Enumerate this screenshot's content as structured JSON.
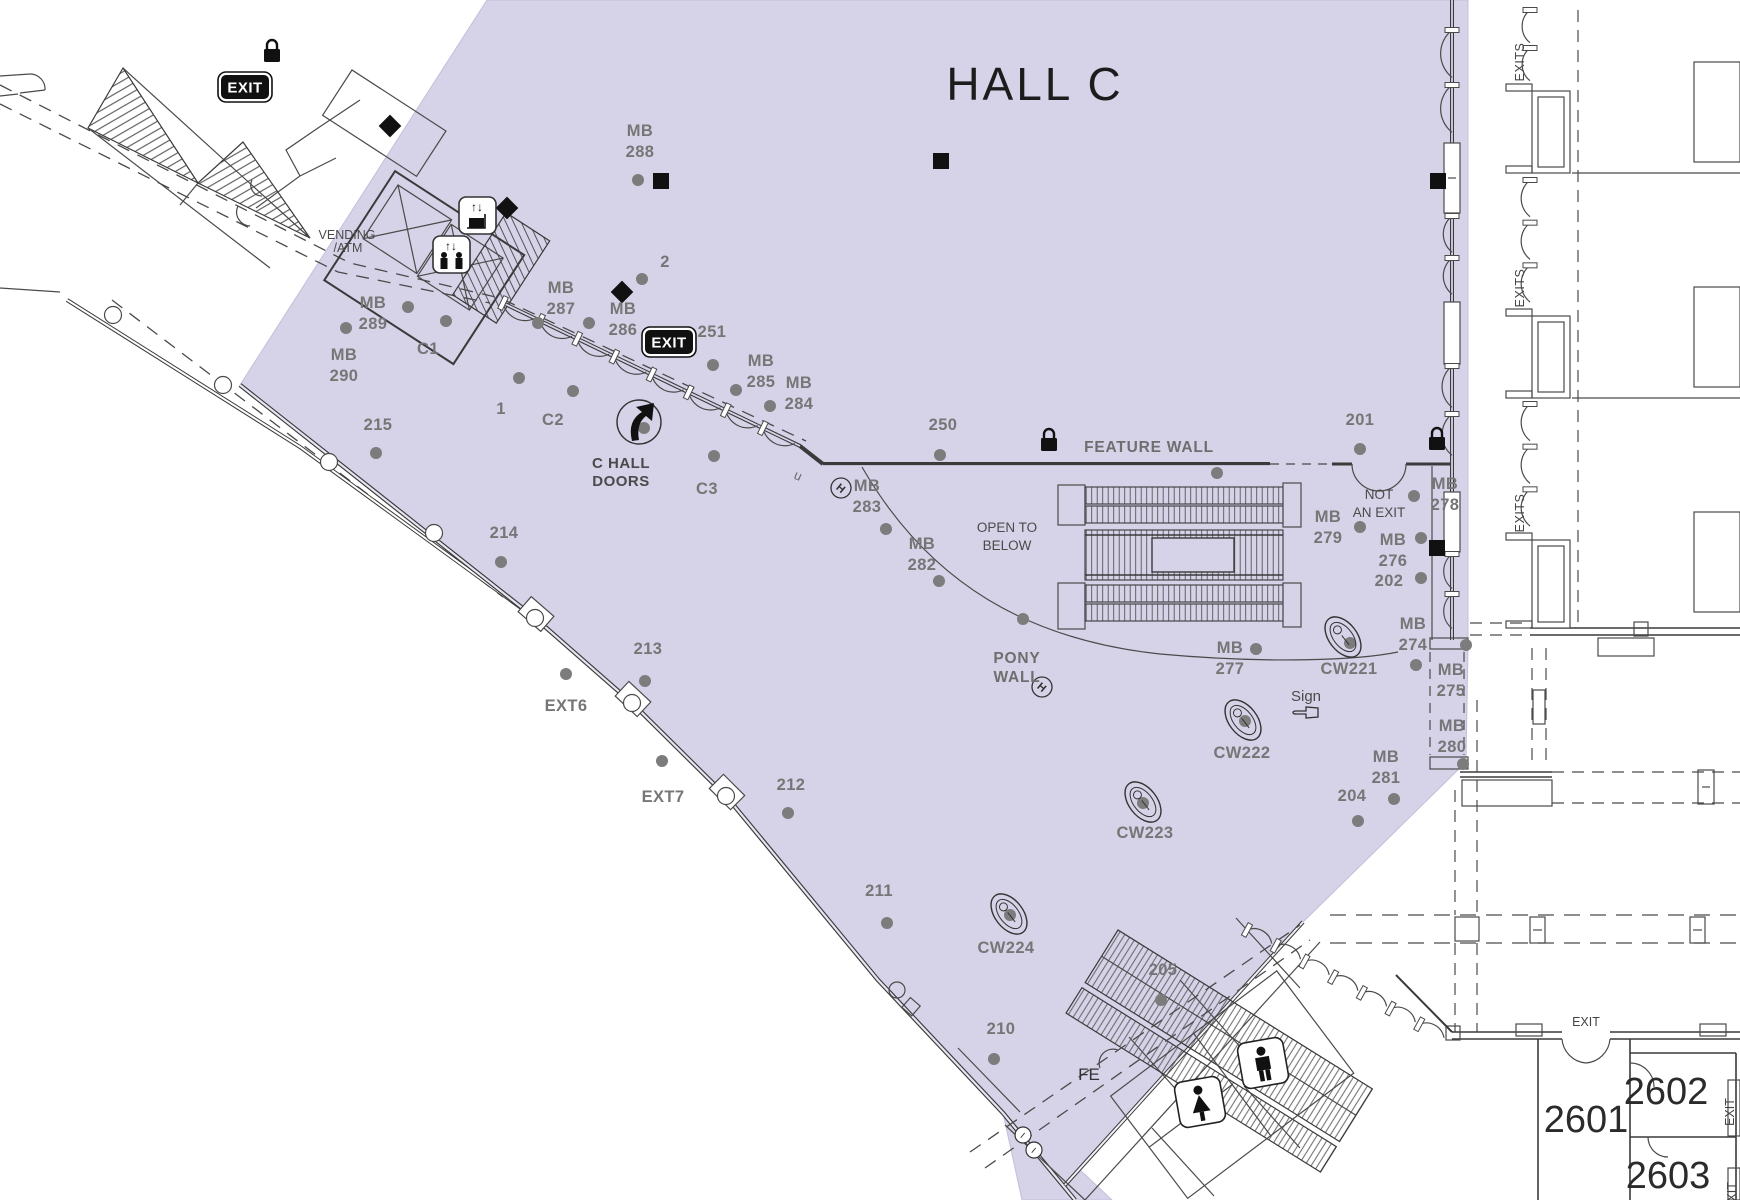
{
  "title": "HALL C",
  "colors": {
    "hall_fill": "#d6d3e8",
    "wall": "#3a3a3a",
    "marker_text": "#767676",
    "dot": "#7c7c7c",
    "dark_text": "#4a4a4a",
    "badge_black": "#111111"
  },
  "labels": {
    "exit": "EXIT",
    "exits": "EXITS",
    "feature_wall": "FEATURE WALL",
    "pony_wall": [
      "PONY",
      "WALL"
    ],
    "open_to_below": [
      "OPEN TO",
      "BELOW"
    ],
    "not_an_exit": [
      "NOT",
      "AN EXIT"
    ],
    "c_hall_doors": [
      "C HALL",
      "DOORS"
    ],
    "vending_atm": [
      "VENDING",
      "/ATM"
    ],
    "sign": "Sign",
    "fe": "FE",
    "u_mark": "u"
  },
  "rooms": [
    {
      "number": "2601",
      "x": 1586,
      "y": 1132
    },
    {
      "number": "2602",
      "x": 1666,
      "y": 1104
    },
    {
      "number": "2603",
      "x": 1668,
      "y": 1188
    }
  ],
  "exit_badges": [
    {
      "x": 245,
      "y": 87
    },
    {
      "x": 669,
      "y": 342
    }
  ],
  "exit_small_labels": [
    {
      "x": 1586,
      "y": 1026,
      "rotate": 0
    },
    {
      "x": 1734,
      "y": 1112,
      "rotate": -90
    },
    {
      "x": 1736,
      "y": 1196,
      "rotate": -90
    }
  ],
  "exits_corridor_labels": [
    {
      "x": 1524,
      "y": 62
    },
    {
      "x": 1524,
      "y": 288
    },
    {
      "x": 1524,
      "y": 513
    }
  ],
  "markers": [
    {
      "lines": [
        "MB",
        "288"
      ],
      "x": 640,
      "y": 136
    },
    {
      "lines": [
        "MB",
        "289"
      ],
      "x": 373,
      "y": 308
    },
    {
      "lines": [
        "MB",
        "290"
      ],
      "x": 344,
      "y": 360
    },
    {
      "lines": [
        "MB",
        "287"
      ],
      "x": 561,
      "y": 293
    },
    {
      "lines": [
        "MB",
        "286"
      ],
      "x": 623,
      "y": 314
    },
    {
      "lines": [
        "MB",
        "285"
      ],
      "x": 761,
      "y": 366
    },
    {
      "lines": [
        "MB",
        "284"
      ],
      "x": 799,
      "y": 388
    },
    {
      "lines": [
        "MB",
        "283"
      ],
      "x": 867,
      "y": 491
    },
    {
      "lines": [
        "MB",
        "282"
      ],
      "x": 922,
      "y": 549
    },
    {
      "lines": [
        "MB",
        "279"
      ],
      "x": 1328,
      "y": 522
    },
    {
      "lines": [
        "MB",
        "276"
      ],
      "x": 1393,
      "y": 545
    },
    {
      "lines": [
        "MB",
        "278"
      ],
      "x": 1445,
      "y": 489
    },
    {
      "lines": [
        "MB",
        "274"
      ],
      "x": 1413,
      "y": 629
    },
    {
      "lines": [
        "MB",
        "275"
      ],
      "x": 1451,
      "y": 675
    },
    {
      "lines": [
        "MB",
        "280"
      ],
      "x": 1452,
      "y": 731
    },
    {
      "lines": [
        "MB",
        "281"
      ],
      "x": 1386,
      "y": 762
    },
    {
      "lines": [
        "MB",
        "277"
      ],
      "x": 1230,
      "y": 653
    },
    {
      "lines": [
        "215"
      ],
      "x": 378,
      "y": 430
    },
    {
      "lines": [
        "214"
      ],
      "x": 504,
      "y": 538
    },
    {
      "lines": [
        "213"
      ],
      "x": 648,
      "y": 654
    },
    {
      "lines": [
        "212"
      ],
      "x": 791,
      "y": 790
    },
    {
      "lines": [
        "211"
      ],
      "x": 879,
      "y": 896
    },
    {
      "lines": [
        "210"
      ],
      "x": 1001,
      "y": 1034
    },
    {
      "lines": [
        "205"
      ],
      "x": 1163,
      "y": 975
    },
    {
      "lines": [
        "204"
      ],
      "x": 1352,
      "y": 801
    },
    {
      "lines": [
        "202"
      ],
      "x": 1389,
      "y": 586
    },
    {
      "lines": [
        "201"
      ],
      "x": 1360,
      "y": 425
    },
    {
      "lines": [
        "250"
      ],
      "x": 943,
      "y": 430
    },
    {
      "lines": [
        "251"
      ],
      "x": 712,
      "y": 337
    },
    {
      "lines": [
        "1"
      ],
      "x": 501,
      "y": 414
    },
    {
      "lines": [
        "2"
      ],
      "x": 665,
      "y": 267
    },
    {
      "lines": [
        "C1"
      ],
      "x": 428,
      "y": 354
    },
    {
      "lines": [
        "C2"
      ],
      "x": 553,
      "y": 425
    },
    {
      "lines": [
        "C3"
      ],
      "x": 707,
      "y": 494
    },
    {
      "lines": [
        "EXT6"
      ],
      "x": 566,
      "y": 711
    },
    {
      "lines": [
        "EXT7"
      ],
      "x": 663,
      "y": 802
    },
    {
      "lines": [
        "CW221"
      ],
      "x": 1349,
      "y": 674
    },
    {
      "lines": [
        "CW222"
      ],
      "x": 1242,
      "y": 758
    },
    {
      "lines": [
        "CW223"
      ],
      "x": 1145,
      "y": 838
    },
    {
      "lines": [
        "CW224"
      ],
      "x": 1006,
      "y": 953
    }
  ],
  "dots": [
    [
      638,
      180
    ],
    [
      642,
      279
    ],
    [
      519,
      378
    ],
    [
      573,
      391
    ],
    [
      538,
      323
    ],
    [
      589,
      323
    ],
    [
      446,
      321
    ],
    [
      408,
      307
    ],
    [
      346,
      328
    ],
    [
      376,
      453
    ],
    [
      501,
      562
    ],
    [
      713,
      365
    ],
    [
      736,
      390
    ],
    [
      770,
      406
    ],
    [
      714,
      456
    ],
    [
      644,
      428
    ],
    [
      645,
      681
    ],
    [
      788,
      813
    ],
    [
      887,
      923
    ],
    [
      994,
      1059
    ],
    [
      1161,
      1000
    ],
    [
      886,
      529
    ],
    [
      939,
      581
    ],
    [
      940,
      455
    ],
    [
      1217,
      473
    ],
    [
      1023,
      619
    ],
    [
      1256,
      649
    ],
    [
      1360,
      449
    ],
    [
      1360,
      527
    ],
    [
      1421,
      538
    ],
    [
      1421,
      578
    ],
    [
      1414,
      496
    ],
    [
      1466,
      645
    ],
    [
      1416,
      665
    ],
    [
      1463,
      764
    ],
    [
      1394,
      799
    ],
    [
      1358,
      821
    ],
    [
      1350,
      643
    ],
    [
      1245,
      721
    ],
    [
      1143,
      803
    ],
    [
      1010,
      915
    ],
    [
      566,
      674
    ],
    [
      662,
      761
    ]
  ],
  "symbols": {
    "black_squares": [
      [
        661,
        181
      ],
      [
        941,
        161
      ],
      [
        1438,
        181
      ],
      [
        1437,
        548
      ]
    ],
    "diamonds": [
      [
        390,
        126
      ],
      [
        507,
        208
      ],
      [
        622,
        292
      ]
    ],
    "locks": [
      [
        272,
        52
      ],
      [
        1049,
        441
      ],
      [
        1437,
        440
      ]
    ],
    "hose_circles": [
      [
        841,
        488
      ],
      [
        1042,
        687
      ]
    ],
    "info_circles": [
      [
        1023,
        1135
      ],
      [
        1034,
        1150
      ]
    ],
    "column_circles": [
      [
        113,
        315
      ],
      [
        223,
        385
      ],
      [
        329,
        462
      ],
      [
        434,
        533
      ],
      [
        535,
        618
      ],
      [
        632,
        703
      ],
      [
        726,
        796
      ]
    ],
    "fountains": [
      [
        1343,
        637
      ],
      [
        1243,
        720
      ],
      [
        1143,
        802
      ],
      [
        1009,
        914
      ]
    ]
  }
}
